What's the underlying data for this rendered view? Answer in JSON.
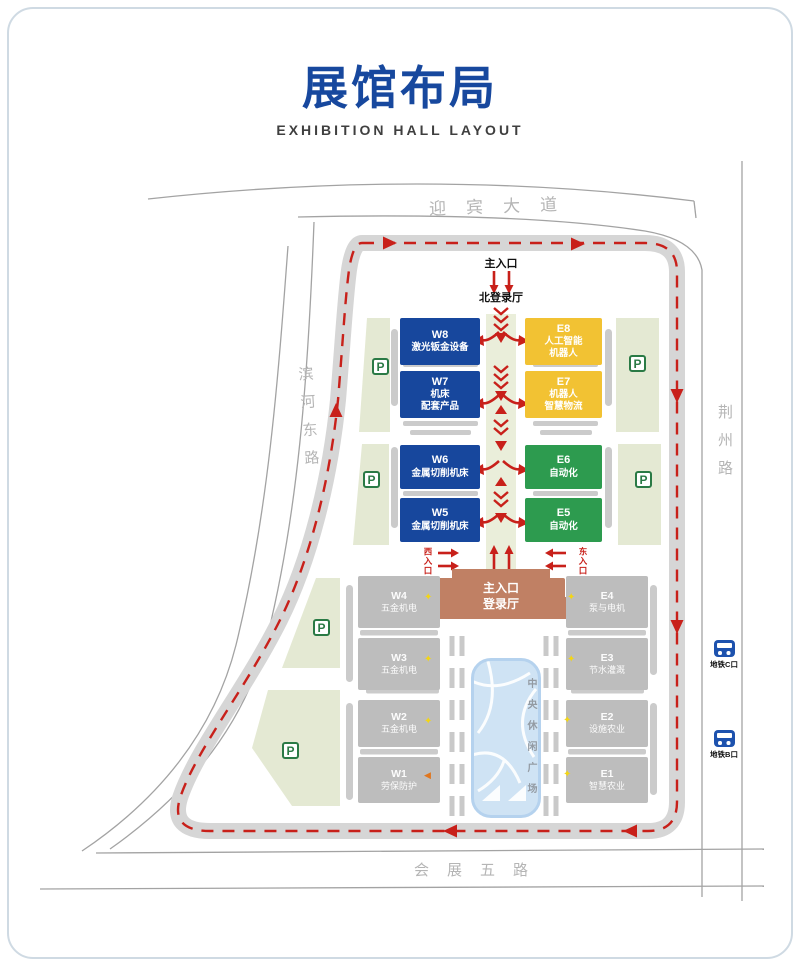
{
  "page": {
    "title": "展馆布局",
    "subtitle": "EXHIBITION HALL LAYOUT"
  },
  "roads": {
    "north": "迎宾大道",
    "west": "滨河东路",
    "east": "荆州路",
    "south": "会展五路"
  },
  "entrances": {
    "north_main": "主入口",
    "north_hall": "北登录厅",
    "main_hall": "主入口\n登录厅",
    "west": "西入口",
    "east": "东入口"
  },
  "halls": {
    "upper_west": [
      {
        "id": "W8",
        "label": "激光钣金设备"
      },
      {
        "id": "W7",
        "label": "机床\n配套产品"
      },
      {
        "id": "W6",
        "label": "金属切削机床"
      },
      {
        "id": "W5",
        "label": "金属切削机床"
      }
    ],
    "upper_east": [
      {
        "id": "E8",
        "label": "人工智能\n机器人"
      },
      {
        "id": "E7",
        "label": "机器人\n智慧物流"
      },
      {
        "id": "E6",
        "label": "自动化"
      },
      {
        "id": "E5",
        "label": "自动化"
      }
    ],
    "lower_west": [
      {
        "id": "W4",
        "label": "五金机电"
      },
      {
        "id": "W3",
        "label": "五金机电"
      },
      {
        "id": "W2",
        "label": "五金机电"
      },
      {
        "id": "W1",
        "label": "劳保防护"
      }
    ],
    "lower_east": [
      {
        "id": "E4",
        "label": "泵与电机"
      },
      {
        "id": "E3",
        "label": "节水灌溉"
      },
      {
        "id": "E2",
        "label": "设施农业"
      },
      {
        "id": "E1",
        "label": "智慧农业"
      }
    ]
  },
  "plaza": {
    "label": "中央休闲广场"
  },
  "metro": {
    "exit_c": "地铁C口",
    "exit_b": "地铁B口"
  },
  "parking": {
    "label": "P"
  },
  "icons": {
    "highlight_star": "✦",
    "w1_arrow": "◀"
  },
  "colors": {
    "title_blue": "#17489e",
    "hall_blue": "#17479d",
    "hall_yellow": "#f2c233",
    "hall_green": "#2d9b4f",
    "hall_gray": "#bdbdbd",
    "entrance_brown": "#c08064",
    "route_red": "#c8201a",
    "parking_green": "#2a7a45",
    "metro_blue": "#1d52ae",
    "road_gray": "#d6d6d6",
    "zone_green": "#e4e9d3",
    "corridor_green": "#eaeeda",
    "plaza_blue": "#cfe3f4"
  }
}
